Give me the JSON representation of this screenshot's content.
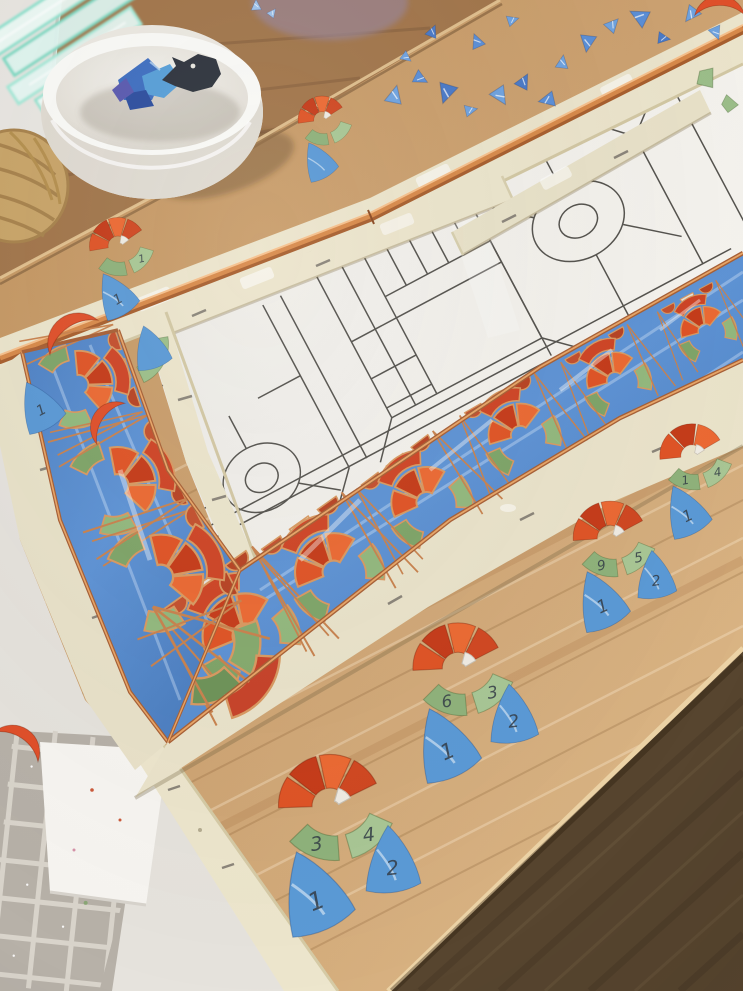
{
  "scene": {
    "subject": "stained-glass mosaic border panel in progress on a wooden workbench",
    "visible_objects": [
      "white-bowl-with-blue-glass",
      "fish-shaped-dark-glass-piece",
      "glass-sheet-stack",
      "wicker-basket",
      "blue-glass-shards",
      "copper-reinforcement-rod",
      "cream-wood-battens",
      "printed-pattern-paper",
      "copper-foiled-glass-border",
      "numbered-flower-piece-kits",
      "grid-textured-glass-sheet",
      "white-paper-sheet",
      "oak-board",
      "dark-wood-floor"
    ]
  },
  "palette": {
    "floor": "#57452f",
    "wood": "#cda271",
    "wood_light": "#dcb786",
    "table_brown": "#a2764b",
    "wall": "#e9e6e1",
    "basket": "#c9a569",
    "bowl": "#f7f5f1",
    "paper": "#f1efea",
    "batten": "#ece5cc",
    "copper": "#c07a42",
    "copper_light": "#f0b57b",
    "blue_glass": "#5b8fd4",
    "blue_glass_light": "#8fc0ea",
    "red_glass": "#cf4526",
    "red_glass_dark": "#b83a1c",
    "orange_glass": "#e06236",
    "green_glass": "#93b77e",
    "green_glass_dark": "#6f9459",
    "white_glass": "#f0ece4",
    "grid_glass": "#b7b1a8",
    "pattern_line": "#55534e",
    "pencil": "#343d47"
  },
  "pencil_numbers_seen": [
    "1",
    "2",
    "3",
    "4",
    "5",
    "6",
    "9"
  ],
  "flower_groups": [
    {
      "x": 118,
      "y": 246,
      "s": 0.62,
      "rot": -22,
      "petals": 4,
      "leaf_nums": [
        "1",
        ""
      ],
      "fan_nums": [
        "1"
      ]
    },
    {
      "x": 322,
      "y": 120,
      "s": 0.52,
      "rot": -20,
      "petals": 4,
      "leaf_nums": [
        "",
        ""
      ],
      "fan_nums": [
        ""
      ]
    },
    {
      "x": 330,
      "y": 806,
      "s": 1.12,
      "rot": -14,
      "petals": 4,
      "leaf_nums": [
        "4",
        "3"
      ],
      "fan_nums": [
        "1",
        "2"
      ]
    },
    {
      "x": 458,
      "y": 668,
      "s": 0.98,
      "rot": -15,
      "petals": 4,
      "leaf_nums": [
        "3",
        "6"
      ],
      "fan_nums": [
        "1",
        "2"
      ]
    },
    {
      "x": 610,
      "y": 538,
      "s": 0.8,
      "rot": -16,
      "petals": 4,
      "leaf_nums": [
        "5",
        "9"
      ],
      "fan_nums": [
        "1",
        "2"
      ]
    },
    {
      "x": 692,
      "y": 456,
      "s": 0.7,
      "rot": -18,
      "petals": 3,
      "leaf_nums": [
        "4",
        "1"
      ],
      "fan_nums": [
        "1"
      ]
    }
  ],
  "loose_pieces": [
    {
      "type": "fan",
      "x": 38,
      "y": 404,
      "s": 0.72,
      "rot": -28,
      "label": "1"
    },
    {
      "type": "crescent",
      "x": 112,
      "y": 424,
      "s": 0.8,
      "rot": -35
    },
    {
      "type": "crescent",
      "x": 75,
      "y": 338,
      "s": 0.95,
      "rot": -15
    },
    {
      "type": "leaf",
      "x": 126,
      "y": 344,
      "s": 0.85,
      "rot": -30
    },
    {
      "type": "fan",
      "x": 150,
      "y": 346,
      "s": 0.62,
      "rot": -18
    },
    {
      "type": "crescent",
      "x": 16,
      "y": 748,
      "s": 0.85,
      "rot": 55
    },
    {
      "type": "crescent",
      "x": 720,
      "y": 16,
      "s": 0.8,
      "rot": 20
    },
    {
      "type": "leafshard",
      "x": 706,
      "y": 78,
      "s": 1,
      "rot": 35
    },
    {
      "type": "leafshard",
      "x": 729,
      "y": 104,
      "s": 0.8,
      "rot": -15
    }
  ],
  "shards": [
    {
      "x": 394,
      "y": 96,
      "s": 1.0,
      "rot": 15
    },
    {
      "x": 420,
      "y": 78,
      "s": 0.8,
      "rot": 120
    },
    {
      "x": 447,
      "y": 92,
      "s": 1.1,
      "rot": 200
    },
    {
      "x": 470,
      "y": 110,
      "s": 0.7,
      "rot": 80
    },
    {
      "x": 500,
      "y": 95,
      "s": 1.0,
      "rot": 150
    },
    {
      "x": 523,
      "y": 82,
      "s": 0.85,
      "rot": 30
    },
    {
      "x": 548,
      "y": 100,
      "s": 0.9,
      "rot": 260
    },
    {
      "x": 562,
      "y": 63,
      "s": 0.75,
      "rot": 10
    },
    {
      "x": 588,
      "y": 42,
      "s": 0.95,
      "rot": 190
    },
    {
      "x": 612,
      "y": 25,
      "s": 0.8,
      "rot": 45
    },
    {
      "x": 640,
      "y": 17,
      "s": 1.05,
      "rot": 300
    },
    {
      "x": 663,
      "y": 38,
      "s": 0.7,
      "rot": 100
    },
    {
      "x": 692,
      "y": 14,
      "s": 0.9,
      "rot": 220
    },
    {
      "x": 716,
      "y": 32,
      "s": 0.75,
      "rot": 160
    },
    {
      "x": 512,
      "y": 20,
      "s": 0.65,
      "rot": 75
    },
    {
      "x": 477,
      "y": 42,
      "s": 0.8,
      "rot": 340
    },
    {
      "x": 432,
      "y": 32,
      "s": 0.7,
      "rot": 25
    },
    {
      "x": 406,
      "y": 57,
      "s": 0.6,
      "rot": 130
    },
    {
      "x": 256,
      "y": 6,
      "s": 0.6,
      "rot": 0,
      "pale": true
    },
    {
      "x": 272,
      "y": 13,
      "s": 0.5,
      "rot": 40,
      "pale": true
    }
  ],
  "border": {
    "bottom_mid": [
      [
        204,
        656
      ],
      [
        360,
        545
      ],
      [
        495,
        443
      ],
      [
        620,
        372
      ],
      [
        743,
        306
      ]
    ],
    "bottom_widths": [
      150,
      120,
      100,
      88,
      80
    ],
    "bottom_motifs": [
      0.07,
      0.24,
      0.42,
      0.6,
      0.77,
      0.93
    ],
    "left_mid": [
      [
        70,
        341
      ],
      [
        100,
        430
      ],
      [
        140,
        520
      ],
      [
        196,
        630
      ]
    ],
    "left_widths": [
      105,
      112,
      122,
      134
    ],
    "left_motifs": [
      0.14,
      0.48,
      0.8
    ]
  },
  "bowl_pieces": [
    "blue-glass-chunk",
    "teal-glass-chunk",
    "navy-glass-chunk",
    "fish-shaped-dark-glass"
  ]
}
